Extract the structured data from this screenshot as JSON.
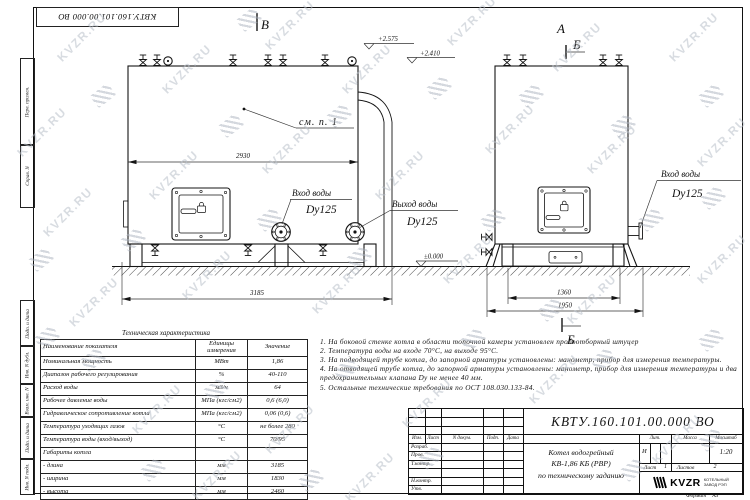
{
  "watermark": {
    "text": "KVZR.RU"
  },
  "frame": {
    "doc_number_rotated": "КВТУ.160.101.00.000 ВО",
    "side_labels": [
      "Перв. примен.",
      "Справ. N",
      "Подп. и дата",
      "Инв. N дубл.",
      "Взам. инв. N",
      "Подп. и дата",
      "Инв. N подл."
    ]
  },
  "drawing": {
    "view_labels": {
      "front_arrow": "В",
      "side_view": "А",
      "section": "Б"
    },
    "elevations": {
      "top": "+2.575",
      "mid": "+2.410",
      "ground": "±0.000"
    },
    "callout": "см. п. 1",
    "dims": {
      "drum_length": "2930",
      "overall_length": "3185",
      "base_width": "1360",
      "overall_width": "1950"
    },
    "ports": {
      "inlet_label": "Вход воды",
      "inlet_dn": "Dy125",
      "outlet_label": "Выход воды",
      "outlet_dn": "Dy125"
    }
  },
  "spec_table": {
    "title": "Техническая характеристика",
    "headers": [
      "Наименование показателя",
      "Единицы измерения",
      "Значение"
    ],
    "rows": [
      [
        "Номинальная мощность",
        "МВт",
        "1,86"
      ],
      [
        "Диапазон рабочего регулирования",
        "%",
        "40-110"
      ],
      [
        "Расход воды",
        "м3/ч",
        "64"
      ],
      [
        "Рабочее давление воды",
        "МПа (кгс/см2)",
        "0,6 (6,0)"
      ],
      [
        "Гидравлическое сопротивление котла",
        "МПа (кгс/см2)",
        "0,06 (0,6)"
      ],
      [
        "Температура уходящих газов",
        "°С",
        "не более 280"
      ],
      [
        "Температура воды (вход/выход)",
        "°С",
        "70/95"
      ],
      [
        "Габариты котла",
        "",
        ""
      ],
      [
        "    - длина",
        "мм",
        "3185"
      ],
      [
        "    - ширина",
        "мм",
        "1830"
      ],
      [
        "    - высота",
        "мм",
        "2460"
      ]
    ]
  },
  "notes": [
    "1.  На боковой стенке котла в области топочной камеры установлен пробоотборный штуцер",
    "2.  Температура воды на входе 70°С, на выходе 95°С.",
    "3.  На подводящей трубе котла, до запорной арматуры установлены: манометр, прибор для измерения температуры.",
    "4.  На отводящей трубе котла, до запорной арматуры установлены: манометр, прибор для измерения температуры и два предохранительных клапана Dу не менее 40 мм.",
    "5.  Остальные технические требования по ОСТ 108.030.133-84."
  ],
  "title_block": {
    "doc_number": "КВТУ.160.101.00.000 ВО",
    "product_name_lines": [
      "Котел водогрейный",
      "КВ-1,86 КБ (РВР)",
      "по техническому заданию"
    ],
    "header_cells": [
      "Изм.",
      "Лист",
      "N докум.",
      "Подп.",
      "Дата"
    ],
    "row_labels": [
      "Разраб.",
      "Пров.",
      "Т.контр.",
      "Н.контр.",
      "Утв."
    ],
    "lit_header": "Лит.",
    "mass_header": "Масса",
    "scale_header": "Масштаб",
    "lit_value": "И",
    "scale_value": "1:20",
    "sheet_label": "Лист",
    "sheet_value": "1",
    "sheets_label": "Листов",
    "sheets_value": "2",
    "company_name": "KVZR",
    "company_sub": [
      "КОТЕЛЬНЫЙ",
      "ЗАВОД РЭП"
    ],
    "format_label": "Формат",
    "format_value": "А3"
  }
}
